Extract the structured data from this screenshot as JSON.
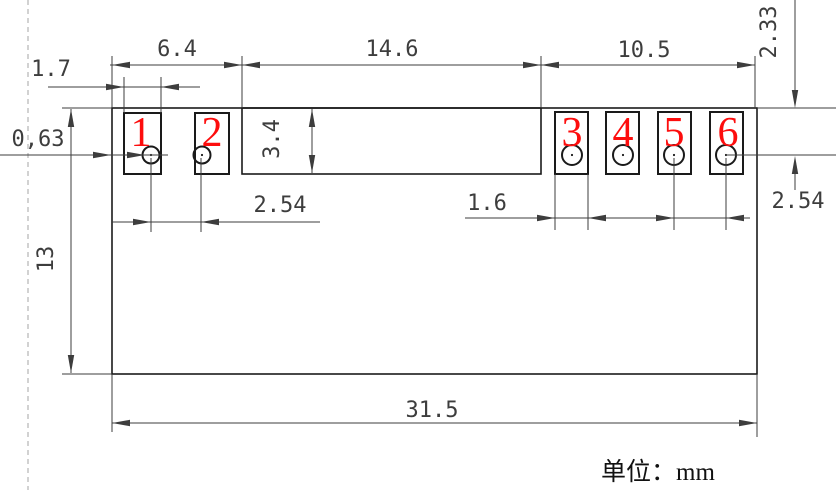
{
  "drawing": {
    "unit_label": "单位：mm",
    "pad_numbers": [
      "1",
      "2",
      "3",
      "4",
      "5",
      "6"
    ],
    "dimensions": {
      "left_section_width": "6.4",
      "middle_section_width": "14.6",
      "right_section_width": "10.5",
      "pad1_width": "1.7",
      "edge_to_pad_gap": "0,63",
      "middle_section_height": "3.4",
      "pads_1_2_pitch": "2.54",
      "module_height": "13",
      "pad3_width": "1.6",
      "pads_5_6_pitch": "2.54",
      "top_edge_to_hole_center": "2.33",
      "module_width": "31.5"
    },
    "colors": {
      "outline": "#1a1a1a",
      "dimension": "#3d3d3d",
      "pad_number": "#fd0d0d",
      "dashed_guide": "#b5b5b5"
    }
  }
}
